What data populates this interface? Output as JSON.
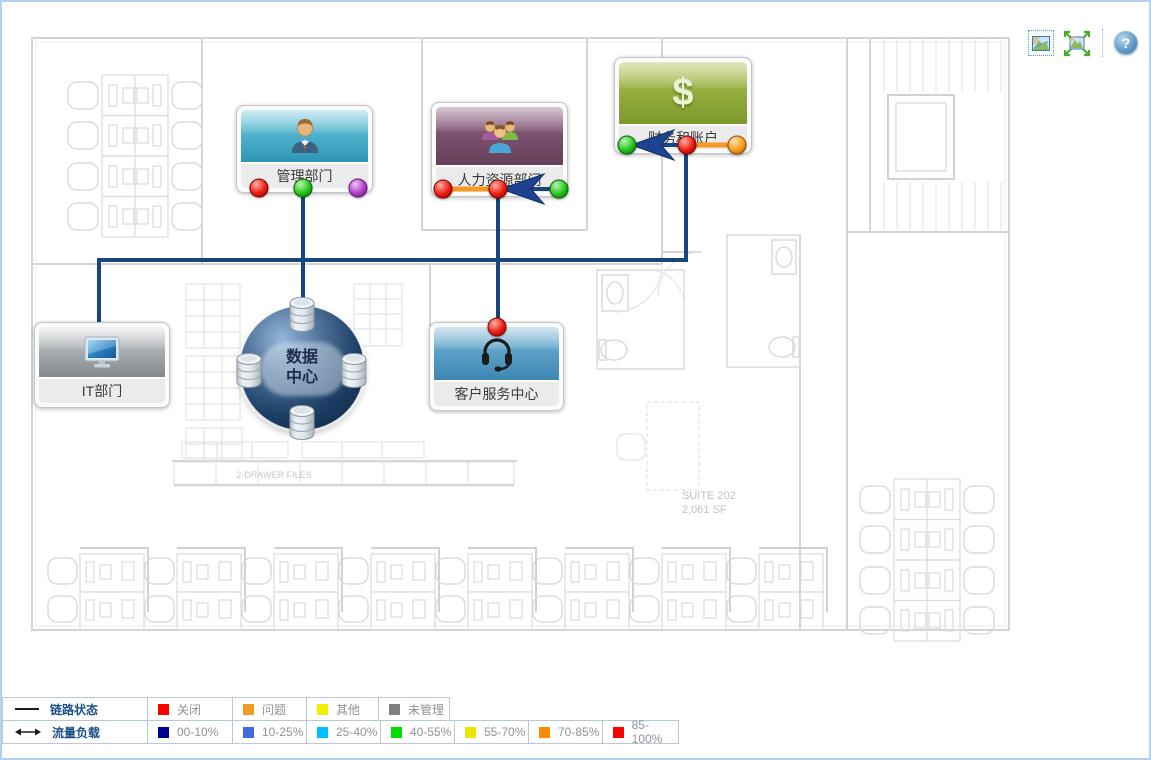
{
  "toolbar": {
    "icons": [
      "zoom-select-map-icon",
      "fit-to-screen-map-icon",
      "help-icon"
    ],
    "help_label": "?"
  },
  "nodes": {
    "management": {
      "label": "管理部门",
      "status_dots": [
        "red",
        "green",
        "purple"
      ]
    },
    "hr": {
      "label": "人力资源部门",
      "status_dots": [
        "red",
        "red",
        "green"
      ]
    },
    "finance": {
      "label": "财务和账户",
      "status_dots": [
        "green",
        "red",
        "orange"
      ],
      "icon_char": "$"
    },
    "it": {
      "label": "IT部门",
      "status_dots": []
    },
    "customer_service": {
      "label": "客户服务中心",
      "status_dots": [
        "red"
      ]
    },
    "datacenter": {
      "label_line1": "数据",
      "label_line2": "中心"
    }
  },
  "links": [
    {
      "from": "管理部门",
      "to": "数据中心",
      "color": "#17457e"
    },
    {
      "from": "IT部门",
      "to": "财务和账户",
      "color": "#17457e"
    },
    {
      "from": "人力资源部门",
      "to": "客户服务中心",
      "color": "#17457e"
    },
    {
      "node": "人力资源部门",
      "segment": "left",
      "load_color": "#f59a23"
    },
    {
      "node": "人力资源部门",
      "segment": "right",
      "direction": "in",
      "color": "#17457e"
    },
    {
      "node": "财务和账户",
      "segment": "left",
      "direction": "in",
      "color": "#17457e"
    },
    {
      "node": "财务和账户",
      "segment": "right",
      "load_color": "#f59a23"
    }
  ],
  "floorplan_text": {
    "suite_line1": "SUITE 202",
    "suite_line2": "2,061 SF",
    "drawer_files": "2-DRAWER FILES"
  },
  "legend": {
    "rows": [
      {
        "label": "链路状态",
        "items": [
          {
            "label": "关闭",
            "color": "#ff0000"
          },
          {
            "label": "问题",
            "color": "#f59a23"
          },
          {
            "label": "其他",
            "color": "#f0f000"
          },
          {
            "label": "未管理",
            "color": "#7f7f7f"
          }
        ]
      },
      {
        "label": "流量负载",
        "items": [
          {
            "label": "00-10%",
            "color": "#00008f"
          },
          {
            "label": "10-25%",
            "color": "#4169e1"
          },
          {
            "label": "25-40%",
            "color": "#00bfff"
          },
          {
            "label": "40-55%",
            "color": "#00dd00"
          },
          {
            "label": "55-70%",
            "color": "#e8e800"
          },
          {
            "label": "70-85%",
            "color": "#ff8c00"
          },
          {
            "label": "85-100%",
            "color": "#ff0000"
          }
        ]
      }
    ]
  },
  "colors": {
    "link": "#17457e",
    "load_orange": "#f59a23",
    "arrow": "#1d4390"
  }
}
